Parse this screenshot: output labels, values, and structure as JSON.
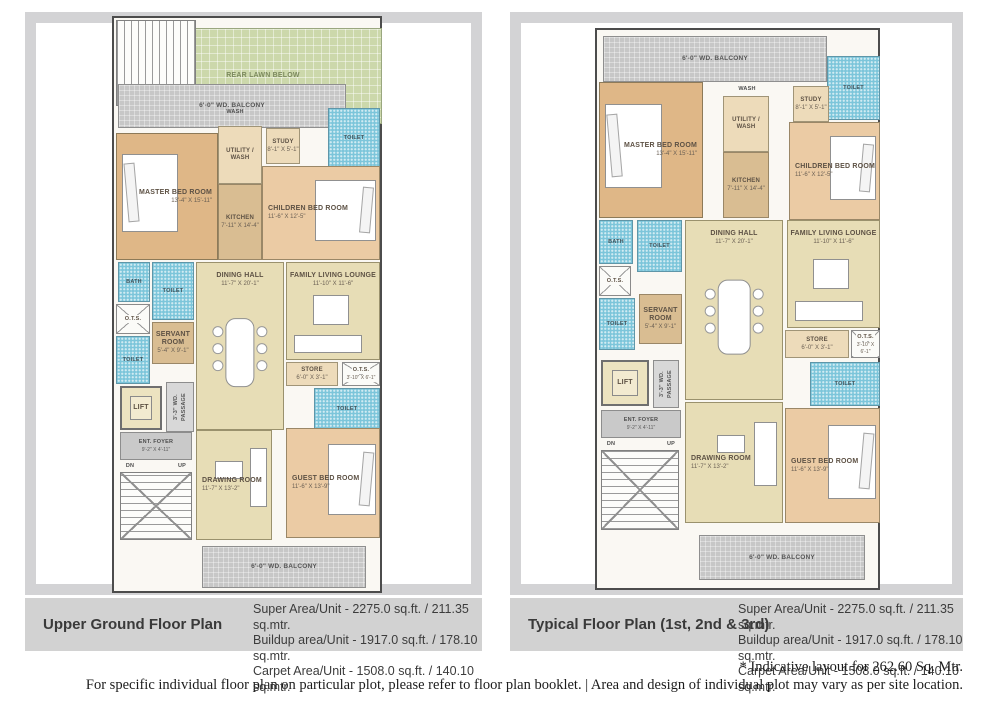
{
  "colors": {
    "caption_bar": "#d2d2d2",
    "frame_gray": "#d3d3d5",
    "lawn_green": "#ccd8ab",
    "balcony_gray": "#c7c7c7",
    "toilet_blue": "#7cc5da",
    "master_tan": "#dfb787",
    "bedroom_peach": "#ebcba4",
    "living_cream": "#e7ddb6",
    "wall_dark": "#4c4c4c"
  },
  "footer": {
    "line1": "* Indicative layout for 262.60 Sq. Mtr.",
    "line2": "For specific individual floor plan on particular plot, please refer to floor plan booklet.  |  Area and design of individual plot may vary as per site location."
  },
  "plans": [
    {
      "name": "upper-ground-floor-plan",
      "caption": "Upper Ground Floor Plan",
      "area_lines": [
        "Super Area/Unit - 2275.0 sq.ft. / 211.35 sq.mtr.",
        "Buildup area/Unit - 1917.0 sq.ft. / 178.10 sq.mtr.",
        "Carpet Area/Unit - 1508.0 sq.ft. / 140.10 sq.mtr."
      ],
      "rooms": [
        {
          "name": "rear-lawn",
          "label": "REAR LAWN BELOW",
          "x": 30,
          "y": 10,
          "w": 238,
          "h": 96,
          "type": "lawn"
        },
        {
          "name": "stairs-top",
          "label": "",
          "x": 2,
          "y": 2,
          "w": 80,
          "h": 86,
          "type": "stairs"
        },
        {
          "name": "balcony-top",
          "label": "6'-0\" WD. BALCONY",
          "x": 4,
          "y": 66,
          "w": 228,
          "h": 44,
          "type": "balcony"
        },
        {
          "name": "toilet-top",
          "label": "TOILET",
          "x": 214,
          "y": 90,
          "w": 52,
          "h": 60,
          "type": "toilet"
        },
        {
          "name": "wash-label",
          "label": "WASH",
          "x": 104,
          "y": 88,
          "w": 34,
          "h": 12,
          "type": "plain"
        },
        {
          "name": "master-bed-room",
          "label": "MASTER BED ROOM",
          "dims": "13'-4\" X 15'-11\"",
          "x": 2,
          "y": 115,
          "w": 102,
          "h": 127,
          "type": "bed",
          "furn": "bed-left",
          "lbl": "right"
        },
        {
          "name": "utility-wash",
          "label": "UTILITY / WASH",
          "x": 104,
          "y": 108,
          "w": 44,
          "h": 58,
          "type": "service"
        },
        {
          "name": "kitchen",
          "label": "KITCHEN",
          "dims": "7'-11\" X 14'-4\"",
          "x": 104,
          "y": 166,
          "w": 44,
          "h": 76,
          "type": "kitchen"
        },
        {
          "name": "study",
          "label": "STUDY",
          "dims": "8'-1\" X 5'-1\"",
          "x": 152,
          "y": 110,
          "w": 34,
          "h": 36,
          "type": "service"
        },
        {
          "name": "children-bed-room",
          "label": "CHILDREN BED ROOM",
          "dims": "11'-6\" X 12'-5\"",
          "x": 148,
          "y": 148,
          "w": 118,
          "h": 94,
          "type": "bed2",
          "furn": "bed-right",
          "lbl": "left"
        },
        {
          "name": "bath",
          "label": "BATH",
          "x": 4,
          "y": 244,
          "w": 32,
          "h": 40,
          "type": "toilet"
        },
        {
          "name": "toilet-2",
          "label": "TOILET",
          "x": 38,
          "y": 244,
          "w": 42,
          "h": 58,
          "type": "toilet"
        },
        {
          "name": "dining-hall",
          "label": "DINING HALL",
          "dims": "11'-7\" X 20'-1\"",
          "x": 82,
          "y": 244,
          "w": 88,
          "h": 168,
          "type": "living",
          "furn": "dining",
          "lbl": "top"
        },
        {
          "name": "family-living-lounge",
          "label": "FAMILY LIVING LOUNGE",
          "dims": "11'-10\" X 11'-6\"",
          "x": 172,
          "y": 244,
          "w": 94,
          "h": 98,
          "type": "living",
          "furn": "sofa",
          "lbl": "top"
        },
        {
          "name": "ots-1",
          "label": "O.T.S.",
          "x": 2,
          "y": 286,
          "w": 34,
          "h": 30,
          "type": "ots"
        },
        {
          "name": "toilet-3",
          "label": "TOILET",
          "x": 2,
          "y": 318,
          "w": 34,
          "h": 48,
          "type": "toilet"
        },
        {
          "name": "servant-room",
          "label": "SERVANT ROOM",
          "dims": "5'-4\" X 9'-1\"",
          "x": 38,
          "y": 304,
          "w": 42,
          "h": 42,
          "type": "servant"
        },
        {
          "name": "store",
          "label": "STORE",
          "dims": "6'-0\" X 3'-1\"",
          "x": 172,
          "y": 344,
          "w": 52,
          "h": 24,
          "type": "service"
        },
        {
          "name": "ots-2",
          "label": "O.T.S.",
          "dims": "3'-10\" X 6'-1\"",
          "x": 228,
          "y": 344,
          "w": 38,
          "h": 24,
          "type": "ots"
        },
        {
          "name": "toilet-4",
          "label": "TOILET",
          "x": 200,
          "y": 370,
          "w": 66,
          "h": 42,
          "type": "toilet"
        },
        {
          "name": "lift",
          "label": "LIFT",
          "x": 6,
          "y": 368,
          "w": 42,
          "h": 44,
          "type": "lift"
        },
        {
          "name": "passage",
          "label": "3'-3\" WD. PASSAGE",
          "x": 52,
          "y": 364,
          "w": 28,
          "h": 50,
          "type": "passage"
        },
        {
          "name": "ent-foyer",
          "label": "ENT. FOYER",
          "dims": "9'-2\" X 4'-11\"",
          "x": 6,
          "y": 414,
          "w": 72,
          "h": 28,
          "type": "foyer"
        },
        {
          "name": "dn-label",
          "label": "DN",
          "x": 6,
          "y": 442,
          "w": 20,
          "h": 11,
          "type": "plain"
        },
        {
          "name": "up-label",
          "label": "UP",
          "x": 58,
          "y": 442,
          "w": 20,
          "h": 11,
          "type": "plain"
        },
        {
          "name": "stairs-main",
          "label": "",
          "x": 6,
          "y": 454,
          "w": 72,
          "h": 68,
          "type": "stairs-x"
        },
        {
          "name": "drawing-room",
          "label": "DRAWING ROOM",
          "dims": "11'-7\" X 13'-2\"",
          "x": 82,
          "y": 412,
          "w": 76,
          "h": 110,
          "type": "living",
          "furn": "sofa2",
          "lbl": "left"
        },
        {
          "name": "guest-bed-room",
          "label": "GUEST BED ROOM",
          "dims": "11'-6\" X 13'-9\"",
          "x": 172,
          "y": 410,
          "w": 94,
          "h": 110,
          "type": "bed2",
          "furn": "bed-right",
          "lbl": "left"
        },
        {
          "name": "balcony-bottom",
          "label": "6'-0\" WD. BALCONY",
          "x": 88,
          "y": 528,
          "w": 164,
          "h": 42,
          "type": "balcony"
        }
      ]
    },
    {
      "name": "typical-floor-plan",
      "caption": "Typical Floor Plan (1st, 2nd & 3rd)",
      "area_lines": [
        "Super Area/Unit - 2275.0 sq.ft. / 211.35 sq.mtr.",
        "Buildup area/Unit - 1917.0 sq.ft. / 178.10 sq.mtr.",
        "Carpet Area/Unit - 1508.0 sq.ft. / 140.10 sq.mtr."
      ],
      "rooms": [
        {
          "name": "balcony-top",
          "label": "6'-0\" WD. BALCONY",
          "x": 6,
          "y": 6,
          "w": 224,
          "h": 46,
          "type": "balcony"
        },
        {
          "name": "toilet-top",
          "label": "TOILET",
          "x": 230,
          "y": 26,
          "w": 53,
          "h": 64,
          "type": "toilet"
        },
        {
          "name": "wash-label",
          "label": "WASH",
          "x": 134,
          "y": 52,
          "w": 32,
          "h": 14,
          "type": "plain"
        },
        {
          "name": "master-bed-room",
          "label": "MASTER BED ROOM",
          "dims": "13'-4\" X 15'-11\"",
          "x": 2,
          "y": 52,
          "w": 104,
          "h": 136,
          "type": "bed",
          "furn": "bed-left",
          "lbl": "right"
        },
        {
          "name": "utility-wash",
          "label": "UTILITY / WASH",
          "x": 126,
          "y": 66,
          "w": 46,
          "h": 56,
          "type": "service"
        },
        {
          "name": "kitchen",
          "label": "KITCHEN",
          "dims": "7'-11\" X 14'-4\"",
          "x": 126,
          "y": 122,
          "w": 46,
          "h": 66,
          "type": "kitchen"
        },
        {
          "name": "study",
          "label": "STUDY",
          "dims": "8'-1\" X 5'-1\"",
          "x": 196,
          "y": 56,
          "w": 36,
          "h": 36,
          "type": "service"
        },
        {
          "name": "children-bed-room",
          "label": "CHILDREN BED ROOM",
          "dims": "11'-6\" X 12'-5\"",
          "x": 192,
          "y": 92,
          "w": 91,
          "h": 98,
          "type": "bed2",
          "furn": "bed-right",
          "lbl": "left"
        },
        {
          "name": "bath",
          "label": "BATH",
          "x": 2,
          "y": 190,
          "w": 34,
          "h": 44,
          "type": "toilet"
        },
        {
          "name": "toilet-2",
          "label": "TOILET",
          "x": 40,
          "y": 190,
          "w": 45,
          "h": 52,
          "type": "toilet"
        },
        {
          "name": "dining-hall",
          "label": "DINING HALL",
          "dims": "11'-7\" X 20'-1\"",
          "x": 88,
          "y": 190,
          "w": 98,
          "h": 180,
          "type": "living",
          "furn": "dining",
          "lbl": "top"
        },
        {
          "name": "family-living-lounge",
          "label": "FAMILY LIVING LOUNGE",
          "dims": "11'-10\" X 11'-6\"",
          "x": 190,
          "y": 190,
          "w": 93,
          "h": 108,
          "type": "living",
          "furn": "sofa",
          "lbl": "top"
        },
        {
          "name": "ots-1",
          "label": "O.T.S.",
          "x": 2,
          "y": 236,
          "w": 32,
          "h": 30,
          "type": "ots"
        },
        {
          "name": "toilet-3",
          "label": "TOILET",
          "x": 2,
          "y": 268,
          "w": 36,
          "h": 52,
          "type": "toilet"
        },
        {
          "name": "servant-room",
          "label": "SERVANT ROOM",
          "dims": "5'-4\" X 9'-1\"",
          "x": 42,
          "y": 264,
          "w": 43,
          "h": 50,
          "type": "servant"
        },
        {
          "name": "store",
          "label": "STORE",
          "dims": "6'-0\" X 3'-1\"",
          "x": 188,
          "y": 300,
          "w": 64,
          "h": 28,
          "type": "service"
        },
        {
          "name": "ots-2",
          "label": "O.T.S.",
          "dims": "3'-10\" X 6'-1\"",
          "x": 254,
          "y": 300,
          "w": 29,
          "h": 28,
          "type": "ots"
        },
        {
          "name": "toilet-4",
          "label": "TOILET",
          "x": 213,
          "y": 332,
          "w": 70,
          "h": 44,
          "type": "toilet"
        },
        {
          "name": "lift",
          "label": "LIFT",
          "x": 4,
          "y": 330,
          "w": 48,
          "h": 46,
          "type": "lift"
        },
        {
          "name": "passage",
          "label": "3'-3\" WD. PASSAGE",
          "x": 56,
          "y": 330,
          "w": 26,
          "h": 48,
          "type": "passage"
        },
        {
          "name": "ent-foyer",
          "label": "ENT. FOYER",
          "dims": "9'-2\" X 4'-11\"",
          "x": 4,
          "y": 380,
          "w": 80,
          "h": 28,
          "type": "foyer"
        },
        {
          "name": "dn-label",
          "label": "DN",
          "x": 4,
          "y": 408,
          "w": 20,
          "h": 11,
          "type": "plain"
        },
        {
          "name": "up-label",
          "label": "UP",
          "x": 64,
          "y": 408,
          "w": 20,
          "h": 11,
          "type": "plain"
        },
        {
          "name": "stairs-main",
          "label": "",
          "x": 4,
          "y": 420,
          "w": 78,
          "h": 80,
          "type": "stairs-x"
        },
        {
          "name": "drawing-room",
          "label": "DRAWING ROOM",
          "dims": "11'-7\" X 13'-2\"",
          "x": 88,
          "y": 372,
          "w": 98,
          "h": 121,
          "type": "living",
          "furn": "sofa2",
          "lbl": "left"
        },
        {
          "name": "guest-bed-room",
          "label": "GUEST BED ROOM",
          "dims": "11'-6\" X 13'-9\"",
          "x": 188,
          "y": 378,
          "w": 95,
          "h": 115,
          "type": "bed2",
          "furn": "bed-right",
          "lbl": "left"
        },
        {
          "name": "balcony-bottom",
          "label": "6'-0\" WD. BALCONY",
          "x": 102,
          "y": 505,
          "w": 166,
          "h": 45,
          "type": "balcony"
        }
      ]
    }
  ]
}
